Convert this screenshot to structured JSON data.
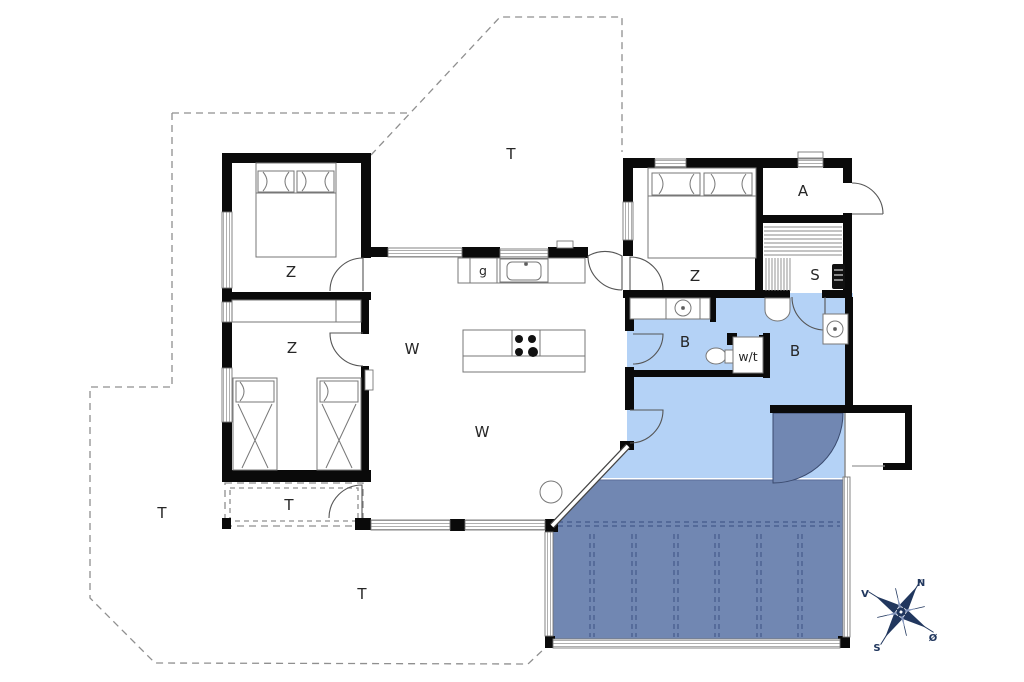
{
  "labels": {
    "bedroom_top_left": "Z",
    "bedroom_mid_left": "Z",
    "bedroom_top_right": "Z",
    "living_upper": "W",
    "living_lower": "W",
    "bath_left": "B",
    "bath_right": "B",
    "annex": "A",
    "sauna": "S",
    "appliance": "g",
    "washer_dryer": "w/t",
    "terrace_top": "T",
    "terrace_left": "T",
    "terrace_small": "T",
    "terrace_bottom": "T"
  },
  "compass": {
    "north": "N",
    "south": "S",
    "west": "V",
    "east": "Ø"
  },
  "colors": {
    "wet_room": "#b4d2f6",
    "terrace_deck": "#7187b2",
    "compass": "#21375e",
    "wall": "#0a0a0a"
  }
}
